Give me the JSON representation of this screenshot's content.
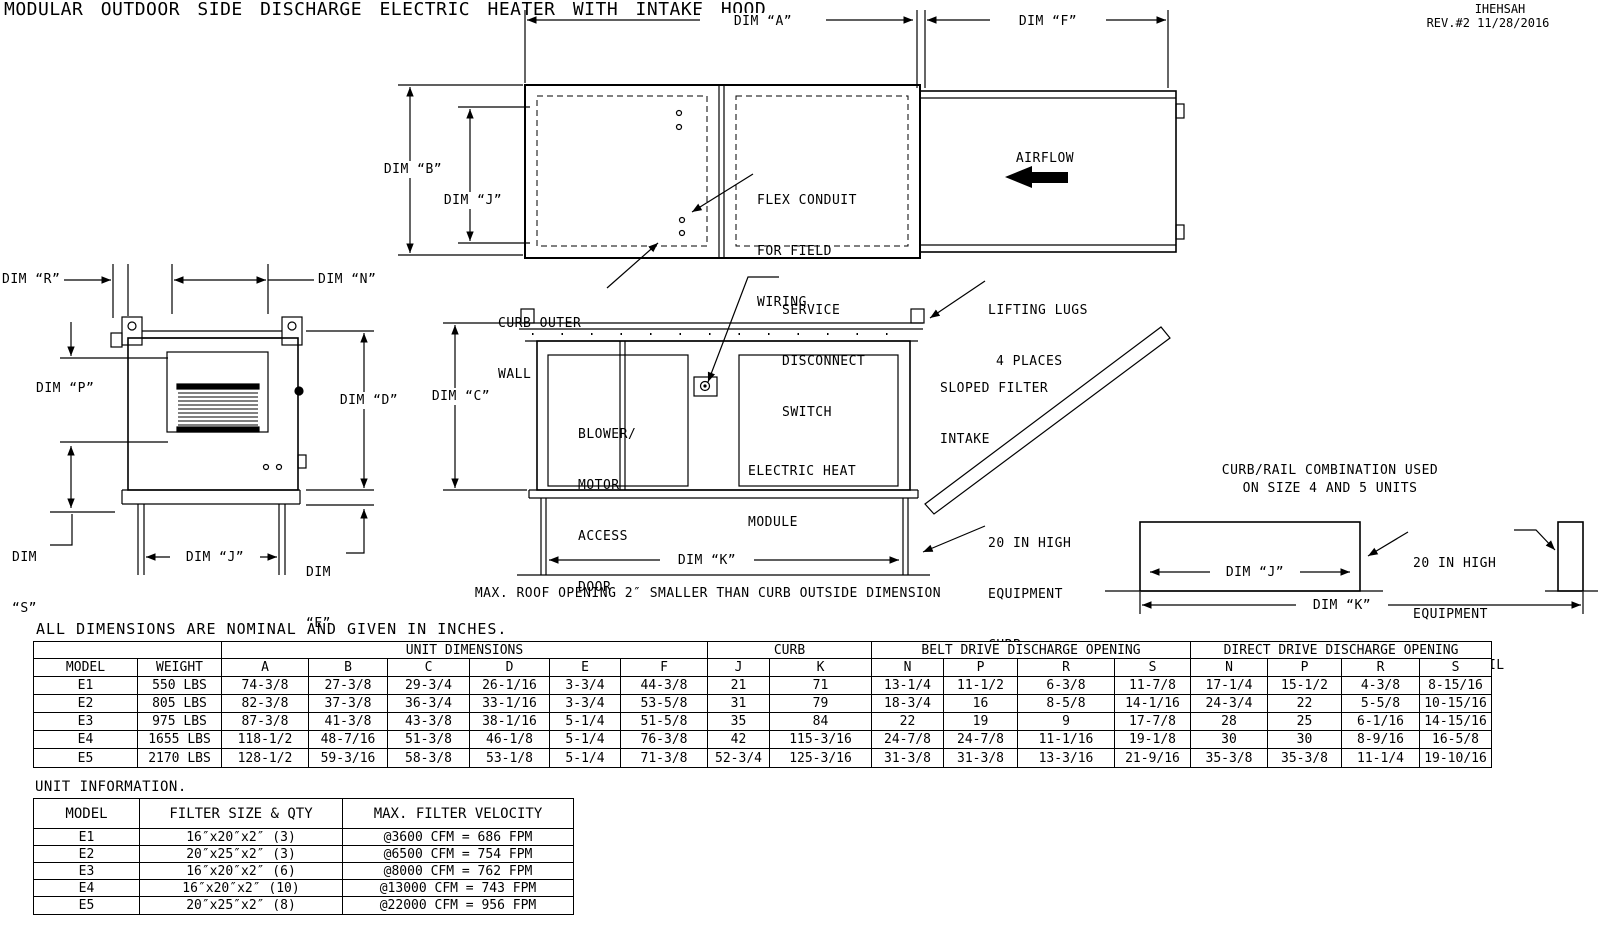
{
  "title": "MODULAR OUTDOOR SIDE DISCHARGE ELECTRIC HEATER WITH INTAKE HOOD",
  "rev": {
    "code": "IHEHSAH",
    "line": "REV.#2  11/28/2016"
  },
  "drawing": {
    "dims": {
      "a": "DIM “A”",
      "b": "DIM “B”",
      "c": "DIM “C”",
      "d": "DIM “D”",
      "e": "DIM",
      "e2": "“E”",
      "f": "DIM “F”",
      "j": "DIM “J”",
      "k": "DIM “K”",
      "n": "DIM “N”",
      "p": "DIM “P”",
      "r": "DIM “R”",
      "s": "DIM",
      "s2": "“S”"
    },
    "labels": {
      "flex_conduit": [
        "FLEX CONDUIT",
        "FOR FIELD",
        "WIRING"
      ],
      "airflow": "AIRFLOW",
      "curb_outer_wall": [
        "CURB OUTER",
        "WALL"
      ],
      "service_disconnect": [
        "SERVICE",
        "DISCONNECT",
        "SWITCH"
      ],
      "lifting_lugs": [
        "LIFTING LUGS",
        "4 PLACES"
      ],
      "sloped_filter": [
        "SLOPED FILTER",
        "INTAKE"
      ],
      "equipment_curb": [
        "20 IN HIGH",
        "EQUIPMENT",
        "CURB"
      ],
      "blower_door": [
        "BLOWER/",
        "MOTOR",
        "ACCESS",
        "DOOR"
      ],
      "electric_heat": [
        "ELECTRIC HEAT",
        "MODULE"
      ],
      "roof_note": "MAX. ROOF OPENING 2″ SMALLER THAN CURB OUTSIDE DIMENSION",
      "curb_rail_title": [
        "CURB/RAIL COMBINATION USED",
        "ON SIZE 4 AND 5 UNITS"
      ],
      "curb_rail_label": [
        "20 IN HIGH",
        "EQUIPMENT",
        "CURB & RAIL"
      ]
    }
  },
  "dims_note": "ALL DIMENSIONS ARE NOMINAL AND GIVEN IN INCHES.",
  "main_table": {
    "group_headers": [
      "",
      "UNIT DIMENSIONS",
      "CURB",
      "BELT DRIVE DISCHARGE OPENING",
      "DIRECT DRIVE DISCHARGE OPENING"
    ],
    "columns": [
      "MODEL",
      "WEIGHT",
      "A",
      "B",
      "C",
      "D",
      "E",
      "F",
      "J",
      "K",
      "N",
      "P",
      "R",
      "S",
      "N",
      "P",
      "R",
      "S"
    ],
    "rows": [
      [
        "E1",
        "550 LBS",
        "74-3/8",
        "27-3/8",
        "29-3/4",
        "26-1/16",
        "3-3/4",
        "44-3/8",
        "21",
        "71",
        "13-1/4",
        "11-1/2",
        "6-3/8",
        "11-7/8",
        "17-1/4",
        "15-1/2",
        "4-3/8",
        "8-15/16"
      ],
      [
        "E2",
        "805 LBS",
        "82-3/8",
        "37-3/8",
        "36-3/4",
        "33-1/16",
        "3-3/4",
        "53-5/8",
        "31",
        "79",
        "18-3/4",
        "16",
        "8-5/8",
        "14-1/16",
        "24-3/4",
        "22",
        "5-5/8",
        "10-15/16"
      ],
      [
        "E3",
        "975 LBS",
        "87-3/8",
        "41-3/8",
        "43-3/8",
        "38-1/16",
        "5-1/4",
        "51-5/8",
        "35",
        "84",
        "22",
        "19",
        "9",
        "17-7/8",
        "28",
        "25",
        "6-1/16",
        "14-15/16"
      ],
      [
        "E4",
        "1655 LBS",
        "118-1/2",
        "48-7/16",
        "51-3/8",
        "46-1/8",
        "5-1/4",
        "76-3/8",
        "42",
        "115-3/16",
        "24-7/8",
        "24-7/8",
        "11-1/16",
        "19-1/8",
        "30",
        "30",
        "8-9/16",
        "16-5/8"
      ],
      [
        "E5",
        "2170 LBS",
        "128-1/2",
        "59-3/16",
        "58-3/8",
        "53-1/8",
        "5-1/4",
        "71-3/8",
        "52-3/4",
        "125-3/16",
        "31-3/8",
        "31-3/8",
        "13-3/16",
        "21-9/16",
        "35-3/8",
        "35-3/8",
        "11-1/4",
        "19-10/16"
      ]
    ]
  },
  "unit_info": {
    "title": "UNIT INFORMATION.",
    "columns": [
      "MODEL",
      "FILTER SIZE & QTY",
      "MAX. FILTER VELOCITY"
    ],
    "rows": [
      [
        "E1",
        "16″x20″x2″ (3)",
        "@3600 CFM = 686 FPM"
      ],
      [
        "E2",
        "20″x25″x2″ (3)",
        "@6500 CFM = 754 FPM"
      ],
      [
        "E3",
        "16″x20″x2″ (6)",
        "@8000 CFM = 762 FPM"
      ],
      [
        "E4",
        "16″x20″x2″ (10)",
        "@13000 CFM = 743 FPM"
      ],
      [
        "E5",
        "20″x25″x2″ (8)",
        "@22000 CFM = 956 FPM"
      ]
    ]
  }
}
